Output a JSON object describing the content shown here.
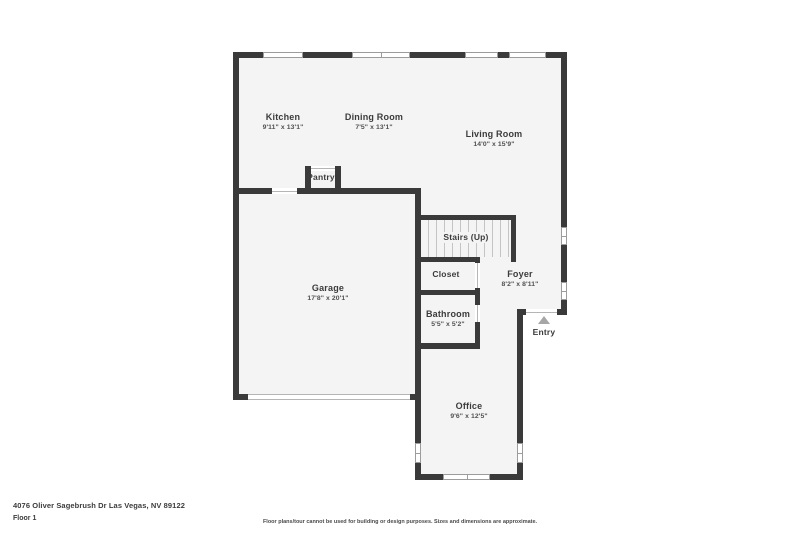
{
  "meta": {
    "address": "4076 Oliver Sagebrush Dr Las Vegas, NV 89122",
    "floor_label": "Floor 1",
    "disclaimer": "Floor plans/tour cannot be used for building or design purposes. Sizes and dimensions are approximate."
  },
  "colors": {
    "wall": "#3a3a3a",
    "room-fill": "#f4f4f4",
    "window-line": "#9c9c9c",
    "door-line": "#b5b5b5",
    "entry-arrow": "#a6a6a6",
    "text": "#3b3b3b"
  },
  "rooms": {
    "kitchen": {
      "name": "Kitchen",
      "dims": "9'11\" x 13'1\""
    },
    "dining": {
      "name": "Dining Room",
      "dims": "7'5\" x 13'1\""
    },
    "living": {
      "name": "Living Room",
      "dims": "14'0\" x 15'9\""
    },
    "pantry": {
      "name": "Pantry"
    },
    "garage": {
      "name": "Garage",
      "dims": "17'8\" x 20'1\""
    },
    "stairs": {
      "name": "Stairs (Up)"
    },
    "closet": {
      "name": "Closet"
    },
    "foyer": {
      "name": "Foyer",
      "dims": "8'2\" x 8'11\""
    },
    "bathroom": {
      "name": "Bathroom",
      "dims": "5'5\" x 5'2\""
    },
    "office": {
      "name": "Office",
      "dims": "9'6\" x 12'5\""
    },
    "entry": {
      "name": "Entry"
    }
  }
}
